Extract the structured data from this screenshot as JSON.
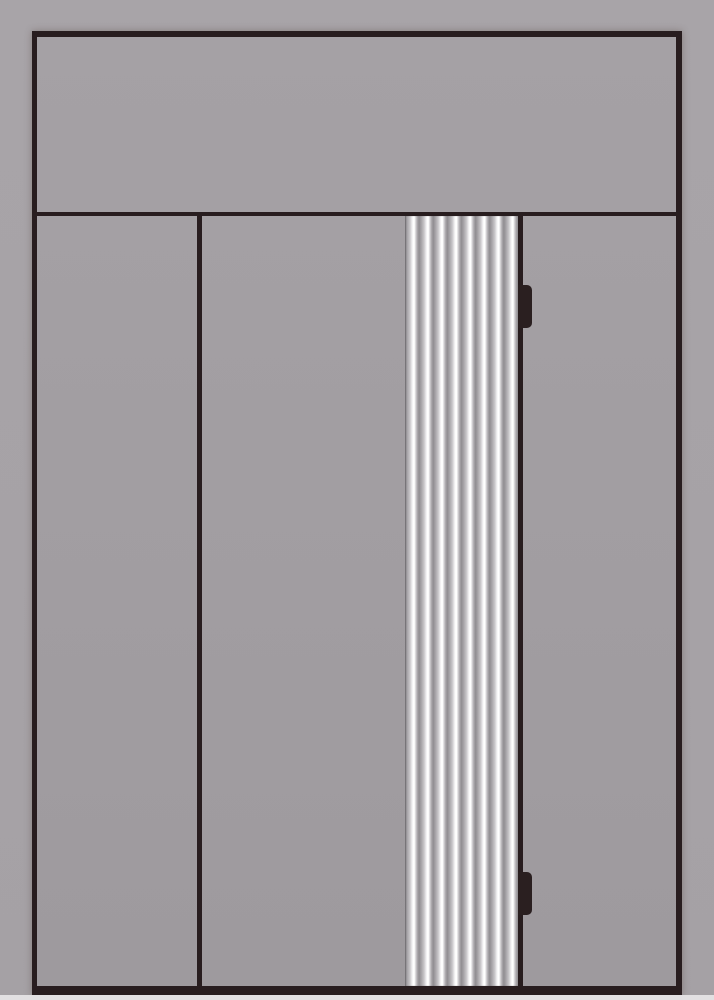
{
  "scene": {
    "title": "door-elevation-drawing",
    "description": "Front elevation design drawing of a door unit: full-width transom panel on top, left sidelite panel, main door leaf with a vertical fluted (reeded) pillar strip, right jamb panel, and two dark hinges on the right edge of the leaf. No text is present in the image.",
    "canvas_width": 714,
    "canvas_height": 1000
  },
  "colors": {
    "page_background": "#a8a4a8",
    "page_background_lower": "#a5a1a5",
    "panel_fill": "#a29ea2",
    "panel_fill_light": "#a5a1a5",
    "panel_fill_dark": "#9e9a9e",
    "frame_dark": "#281d1f",
    "hinge_dark": "#2a1f20",
    "flute_highlight": "#ffffff",
    "flute_shadow": "#908d91",
    "floor_strip": "#e2e0e2"
  },
  "door": {
    "transom": {
      "present": true
    },
    "sidelite_left": {
      "present": true
    },
    "main_leaf": {
      "present": true
    },
    "fluted_strip": {
      "ridge_count": 8
    },
    "right_panel": {
      "present": true
    },
    "hinges": {
      "count": 2,
      "positions": [
        "upper",
        "lower"
      ]
    }
  }
}
